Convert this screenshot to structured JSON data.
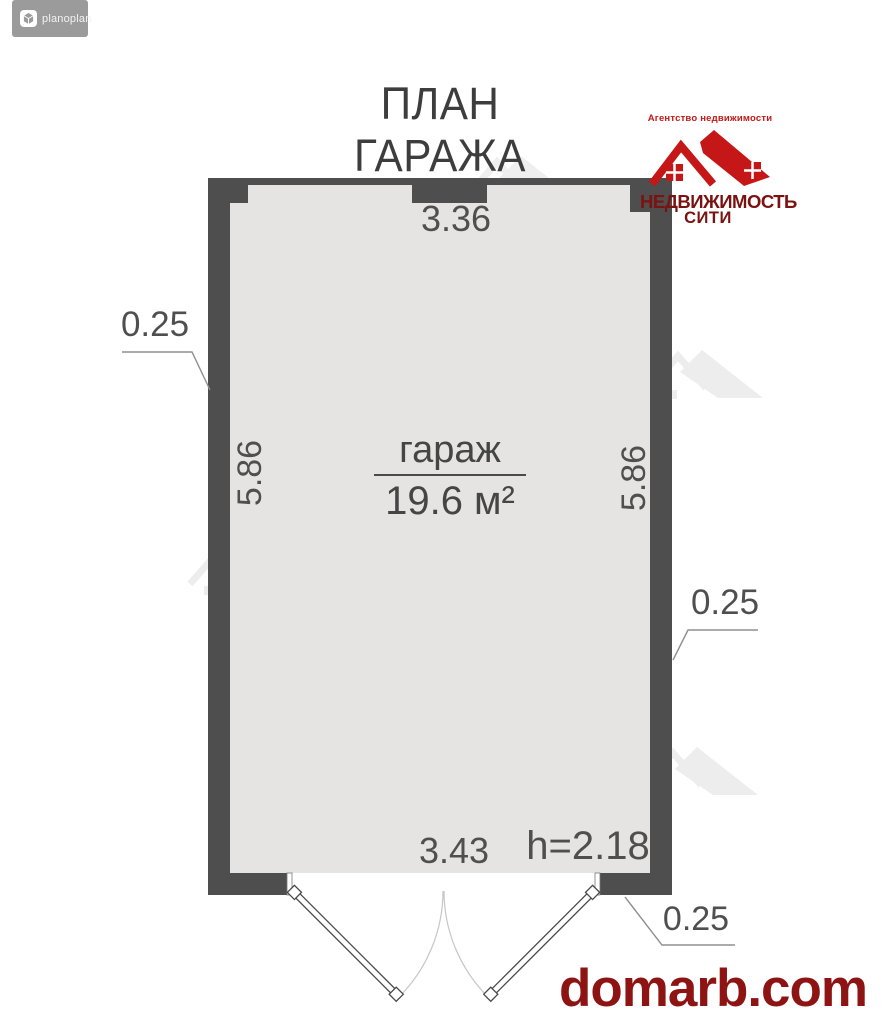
{
  "badge": {
    "label": "planoplan",
    "icon": "planoplan-cube-icon"
  },
  "title": "ПЛАН ГАРАЖА",
  "agency": {
    "tagline": "Агентство недвижимости",
    "name_line1": "НЕДВИЖИМОСТЬ",
    "name_line2": "СИТИ",
    "logo_red": "#c51717",
    "text_maroon": "#7a1210"
  },
  "room": {
    "name": "гараж",
    "area": "19.6 м²"
  },
  "dimensions": {
    "top_width": "3.36",
    "left_wall_thickness": "0.25",
    "left_height": "5.86",
    "right_height": "5.86",
    "right_wall_thickness": "0.25",
    "door_opening_width": "3.43",
    "ceiling_height": "h=2.18",
    "bottom_wall_thickness": "0.25"
  },
  "footer": {
    "site": "domarb.com",
    "color": "#8e1414"
  },
  "colors": {
    "wall": "#4e4e4e",
    "floor": "#e5e4e2",
    "arc": "#c6c6c6",
    "leader": "#8f8f8f"
  }
}
